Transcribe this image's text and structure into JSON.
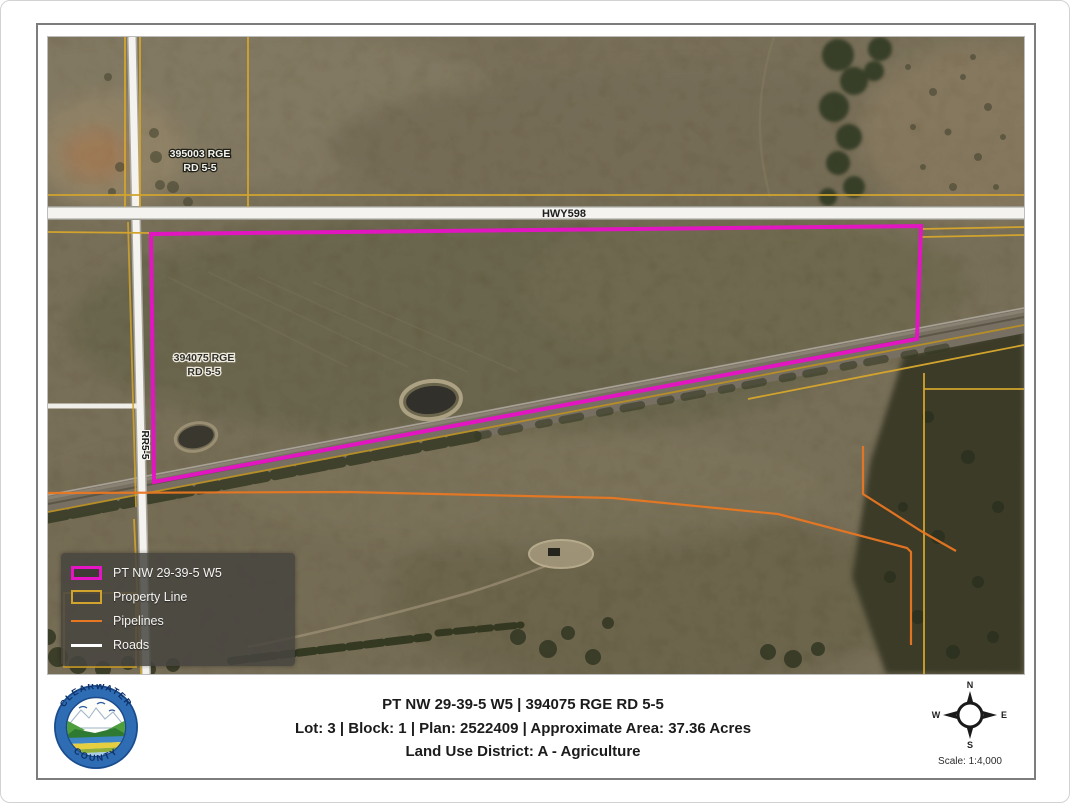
{
  "map": {
    "labels": {
      "hwy": "HWY598",
      "rge_rd_top_line1": "395003 RGE",
      "rge_rd_top_line2": "RD 5-5",
      "rge_rd_mid_line1": "394075 RGE",
      "rge_rd_mid_line2": "RD 5-5",
      "rr": "RR5-5"
    },
    "legend": {
      "items": [
        {
          "label": "PT NW 29-39-5 W5",
          "swatch": "parcel-outline",
          "color": "#E514C4"
        },
        {
          "label": "Property Line",
          "swatch": "rect-outline",
          "color": "#D2A42E"
        },
        {
          "label": "Pipelines",
          "swatch": "line",
          "color": "#E87722"
        },
        {
          "label": "Roads",
          "swatch": "line",
          "color": "#FFFFFF"
        }
      ]
    }
  },
  "footer": {
    "line1": "PT NW 29-39-5 W5 | 394075 RGE RD 5-5",
    "line2": "Lot: 3 | Block: 1 | Plan: 2522409 | Approximate Area: 37.36 Acres",
    "line3": "Land Use District: A - Agriculture"
  },
  "compass": {
    "north": "N",
    "east": "E",
    "south": "S",
    "west": "W",
    "scale_label": "Scale: 1:4,000"
  },
  "logo": {
    "arc_top": "CLEARWATER",
    "arc_bottom": "COUNTY"
  },
  "colors": {
    "parcel": "#E514C4",
    "property_line": "#D2A42E",
    "pipeline": "#E87722",
    "road": "#FFFFFF",
    "legend_background": "rgba(70,68,63,0.85)"
  }
}
